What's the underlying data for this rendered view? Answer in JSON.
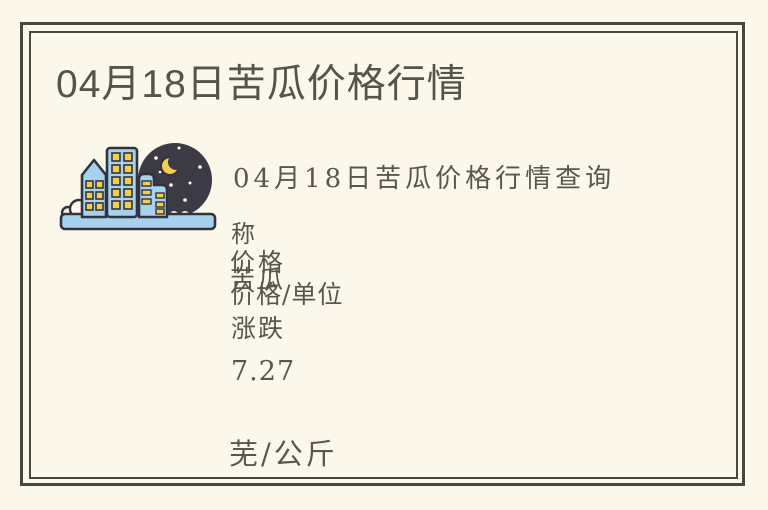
{
  "page": {
    "background_color": "#fbf8eb",
    "frame_color": "#4a483e",
    "title_color": "#56524c",
    "body_text_color": "#5a564e"
  },
  "title": "04月18日苦瓜价格行情",
  "hero": {
    "subtitle": "04月18日苦瓜价格行情查询",
    "illustration": {
      "name": "night-city-skyline",
      "colors": {
        "building_blue": "#a6d2ef",
        "outline_dark": "#34323c",
        "window_yellow": "#f2cf4b",
        "sky_circle_dark": "#3c3a44",
        "moon_yellow": "#f2cf4b",
        "star_white": "#ffffff"
      }
    }
  },
  "price_table": {
    "rows": [
      "称",
      "价格",
      "苦瓜",
      "价格/单位",
      "涨跌",
      "7.27",
      "芜/公斤"
    ]
  }
}
